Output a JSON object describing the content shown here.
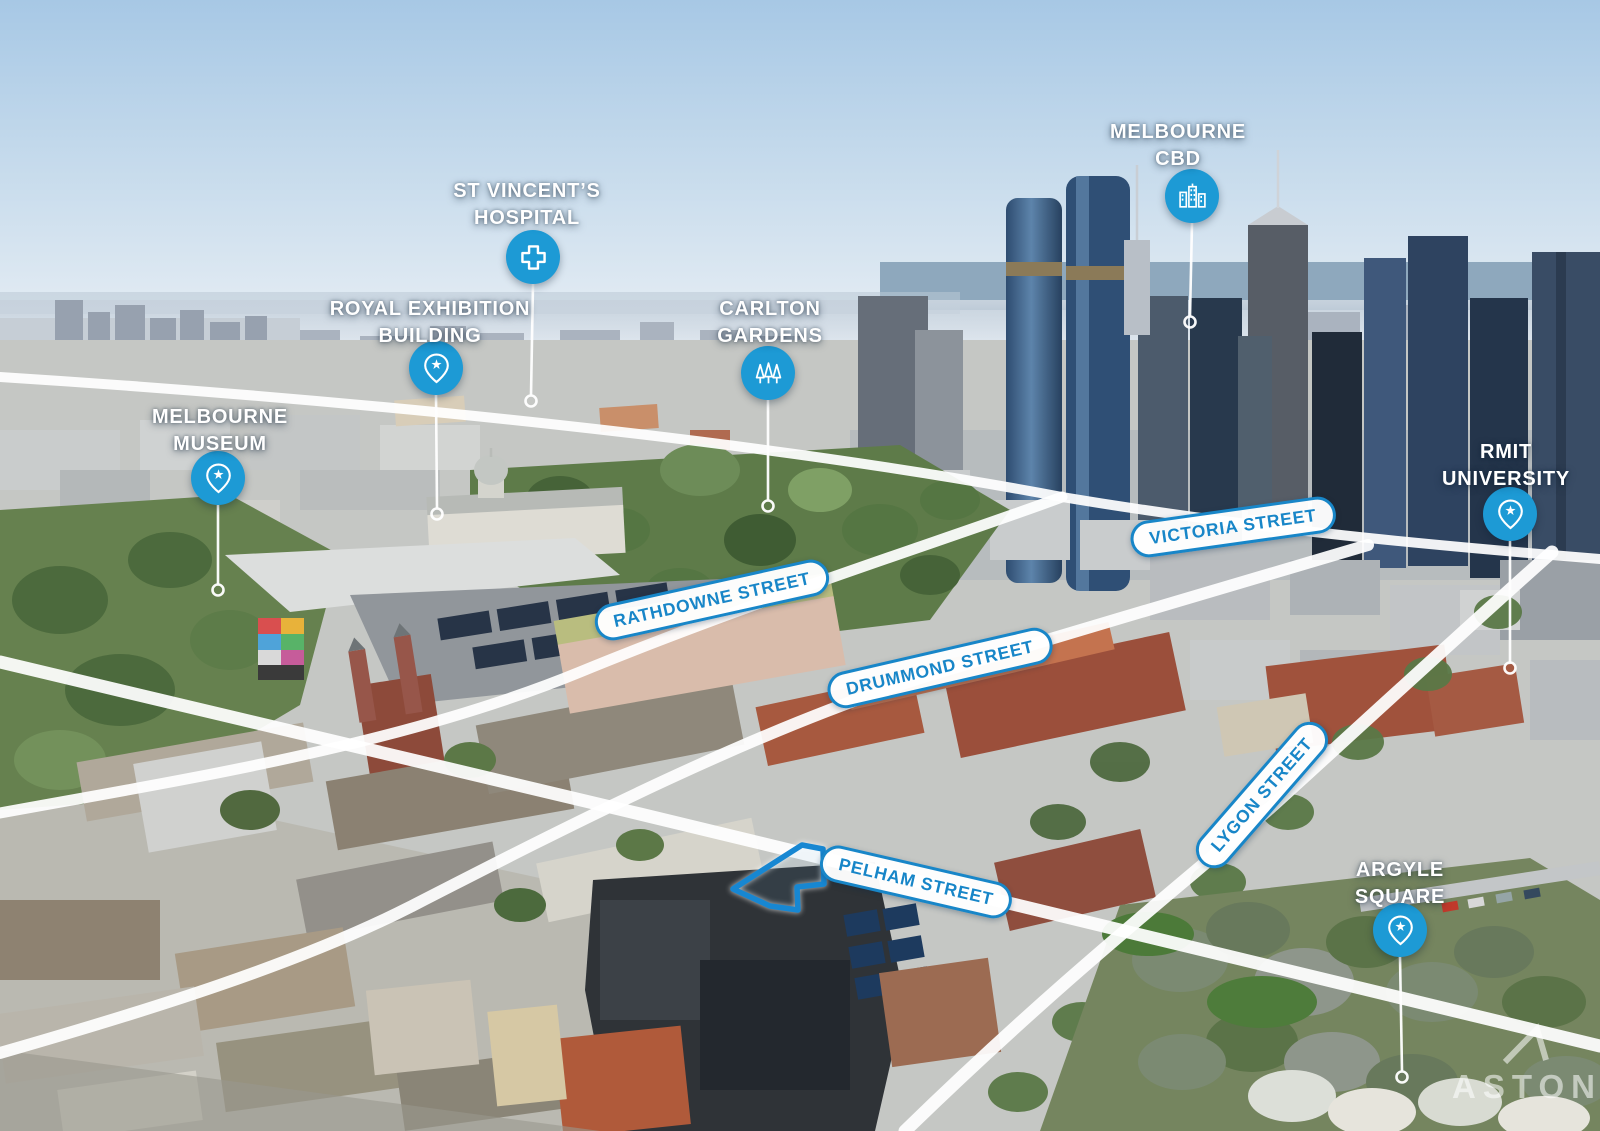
{
  "landmarks": [
    {
      "id": "melbourne-museum",
      "lines": [
        "MELBOURNE",
        "MUSEUM"
      ],
      "icon": "pin-star"
    },
    {
      "id": "royal-exhibition-building",
      "lines": [
        "ROYAL EXHIBITION",
        "BUILDING"
      ],
      "icon": "pin-star"
    },
    {
      "id": "st-vincents-hospital",
      "lines": [
        "ST VINCENT’S",
        "HOSPITAL"
      ],
      "icon": "medical-cross"
    },
    {
      "id": "carlton-gardens",
      "lines": [
        "CARLTON",
        "GARDENS"
      ],
      "icon": "trees"
    },
    {
      "id": "melbourne-cbd",
      "lines": [
        "MELBOURNE",
        "CBD"
      ],
      "icon": "city-buildings"
    },
    {
      "id": "rmit-university",
      "lines": [
        "RMIT",
        "UNIVERSITY"
      ],
      "icon": "pin-star"
    },
    {
      "id": "argyle-square",
      "lines": [
        "ARGYLE",
        "SQUARE"
      ],
      "icon": "pin-star"
    }
  ],
  "streets": [
    {
      "label": "VICTORIA STREET"
    },
    {
      "label": "RATHDOWNE STREET"
    },
    {
      "label": "DRUMMOND STREET"
    },
    {
      "label": "LYGON STREET"
    },
    {
      "label": "PELHAM STREET"
    }
  ],
  "branding": {
    "logo_text": "ASTON"
  },
  "colors": {
    "pin_blue": "#1d9ad5",
    "street_blue": "#1886c8",
    "property_blue": "#1787d2"
  }
}
